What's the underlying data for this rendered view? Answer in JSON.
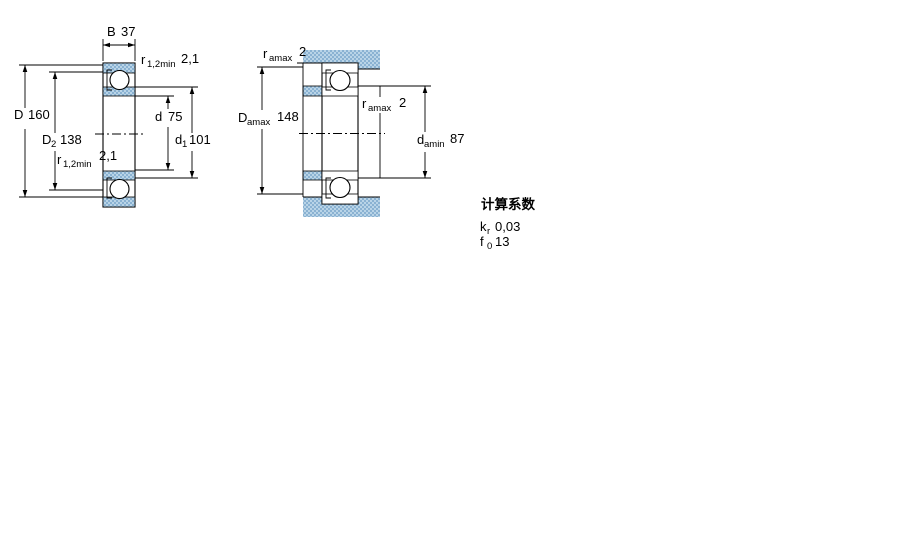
{
  "colors": {
    "hatch_light": "#b9d4e7",
    "hatch_dark": "#8ab2d2",
    "line": "#000000",
    "background": "#ffffff"
  },
  "left_diagram": {
    "B": {
      "sym": "B",
      "val": "37"
    },
    "r_top": {
      "sym": "r",
      "sub": "1,2min",
      "val": "2,1"
    },
    "D": {
      "sym": "D",
      "val": "160"
    },
    "D2": {
      "sym": "D",
      "sub": "2",
      "val": "138"
    },
    "r_bottom": {
      "sym": "r",
      "sub": "1,2min",
      "val": "2,1"
    },
    "d": {
      "sym": "d",
      "val": "75"
    },
    "d1": {
      "sym": "d",
      "sub": "1",
      "val": "101"
    }
  },
  "right_diagram": {
    "r_a_top": {
      "sym": "r",
      "sub": "amax",
      "val": "2"
    },
    "D_amax": {
      "sym": "D",
      "sub": "amax",
      "val": "148"
    },
    "r_a_mid": {
      "sym": "r",
      "sub": "amax",
      "val": "2"
    },
    "d_amin": {
      "sym": "d",
      "sub": "amin",
      "val": "87"
    }
  },
  "calculation_factors": {
    "title": "计算系数",
    "k_r": {
      "sym": "k",
      "sub": "r",
      "val": "0,03"
    },
    "f_0": {
      "sym": "f",
      "sub": "0",
      "val": "13"
    }
  }
}
